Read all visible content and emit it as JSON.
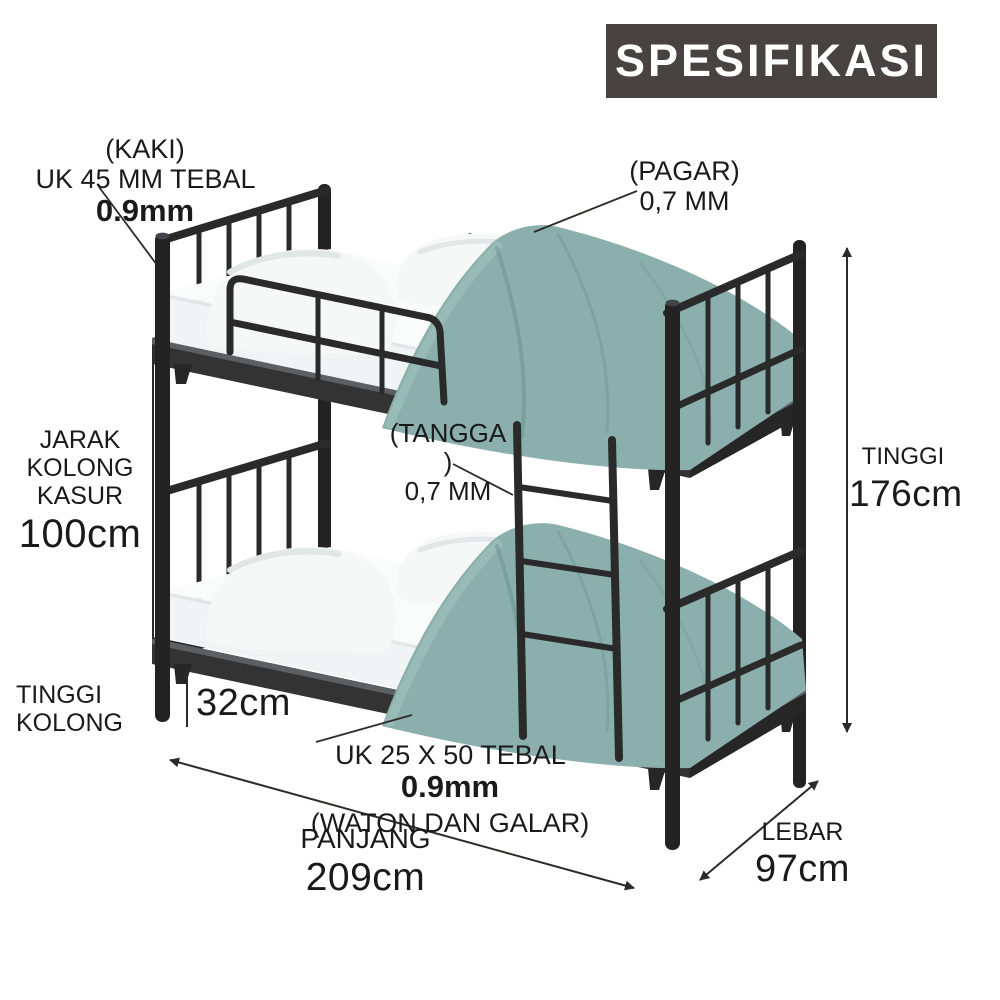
{
  "title": "SPESIFIKASI",
  "colors": {
    "bg": "#ffffff",
    "title_bg": "#484340",
    "text": "#1a1a1a",
    "line": "#2e2a28",
    "frame": "#2a2a2a",
    "frame_dark": "#232323",
    "band": "#333333",
    "band_side": "#262626",
    "band_lip": "#5c6063",
    "duvet": "#8bafac",
    "duvet_light": "#a6c4c1",
    "duvet_dark": "#6d9795",
    "pillow": "#f6f8f8",
    "pillow_shade": "#e1e6e6",
    "mattress": "#f1f4f4"
  },
  "annotations": {
    "kaki": {
      "line1": "(KAKI)",
      "line2": "UK 45 MM TEBAL",
      "line2_bold": "0.9mm"
    },
    "pagar": {
      "line1": "(PAGAR)",
      "line2": "0,7 MM"
    },
    "jarak_kolong": {
      "line1": "JARAK KOLONG",
      "line2": "KASUR",
      "value": "100cm"
    },
    "tangga": {
      "line1": "(TANGGA )",
      "line2": "0,7 MM"
    },
    "tinggi": {
      "label": "TINGGI",
      "value": "176cm"
    },
    "tinggi_kolong": {
      "label": "TINGGI KOLONG",
      "value": "32cm"
    },
    "waton": {
      "line1": "UK 25 X 50 TEBAL",
      "line1_bold": "0.9mm",
      "line2": "(WATON DAN GALAR)"
    },
    "panjang": {
      "label": "PANJANG",
      "value": "209cm"
    },
    "lebar": {
      "label": "LEBAR",
      "value": "97cm"
    }
  }
}
